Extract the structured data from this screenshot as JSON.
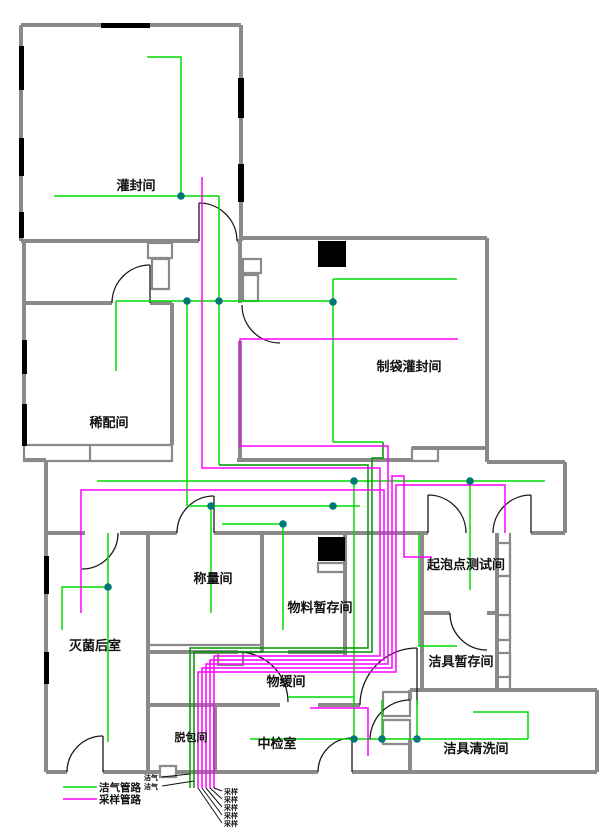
{
  "drawing": {
    "type": "floor-plan piping diagram",
    "colors": {
      "wall": "#8a8a8a",
      "clean_gas_pipe": "#00dc00",
      "sampling_pipe": "#ff00ff",
      "junction_dot": "#007878",
      "text": "#111111"
    }
  },
  "rooms": [
    {
      "label": "灌封间"
    },
    {
      "label": "制袋灌封间"
    },
    {
      "label": "稀配间"
    },
    {
      "label": "称量间"
    },
    {
      "label": "物料暂存间"
    },
    {
      "label": "灭菌后室"
    },
    {
      "label": "起泡点测试间"
    },
    {
      "label": "洁具暂存间"
    },
    {
      "label": "洁具清洗间"
    },
    {
      "label": "物缓间"
    },
    {
      "label": "中检室"
    },
    {
      "label": "脱包间"
    }
  ],
  "legend": {
    "items": [
      {
        "label": "洁气管路",
        "color": "#00dc00"
      },
      {
        "label": "采样管路",
        "color": "#ff00ff"
      }
    ]
  },
  "taps": {
    "left": [
      "洁气",
      "洁气"
    ],
    "right": [
      "采样",
      "采样",
      "采样",
      "采样",
      "采样"
    ]
  }
}
